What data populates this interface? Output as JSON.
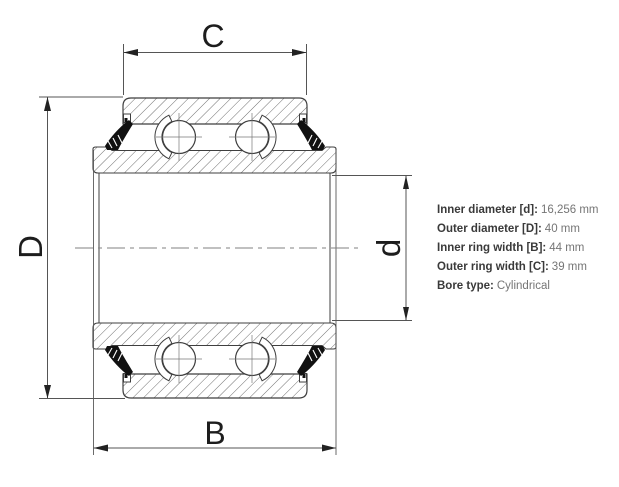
{
  "drawing": {
    "title": "bearing-cross-section",
    "dim_top_label": "C",
    "dim_bottom_label": "B",
    "dim_left_label": "D",
    "dim_right_label": "d"
  },
  "specs": {
    "items": [
      {
        "label": "Inner diameter [d]:",
        "value": "16,256 mm"
      },
      {
        "label": "Outer diameter [D]:",
        "value": "40 mm"
      },
      {
        "label": "Inner ring width [B]:",
        "value": "44 mm"
      },
      {
        "label": "Outer ring width [C]:",
        "value": "39 mm"
      },
      {
        "label": "Bore type:",
        "value": "Cylindrical"
      }
    ]
  },
  "colors": {
    "line": "#3f3f3f",
    "hatch": "#606060",
    "dim_line": "#555555",
    "seal": "#111111",
    "background": "#ffffff"
  }
}
